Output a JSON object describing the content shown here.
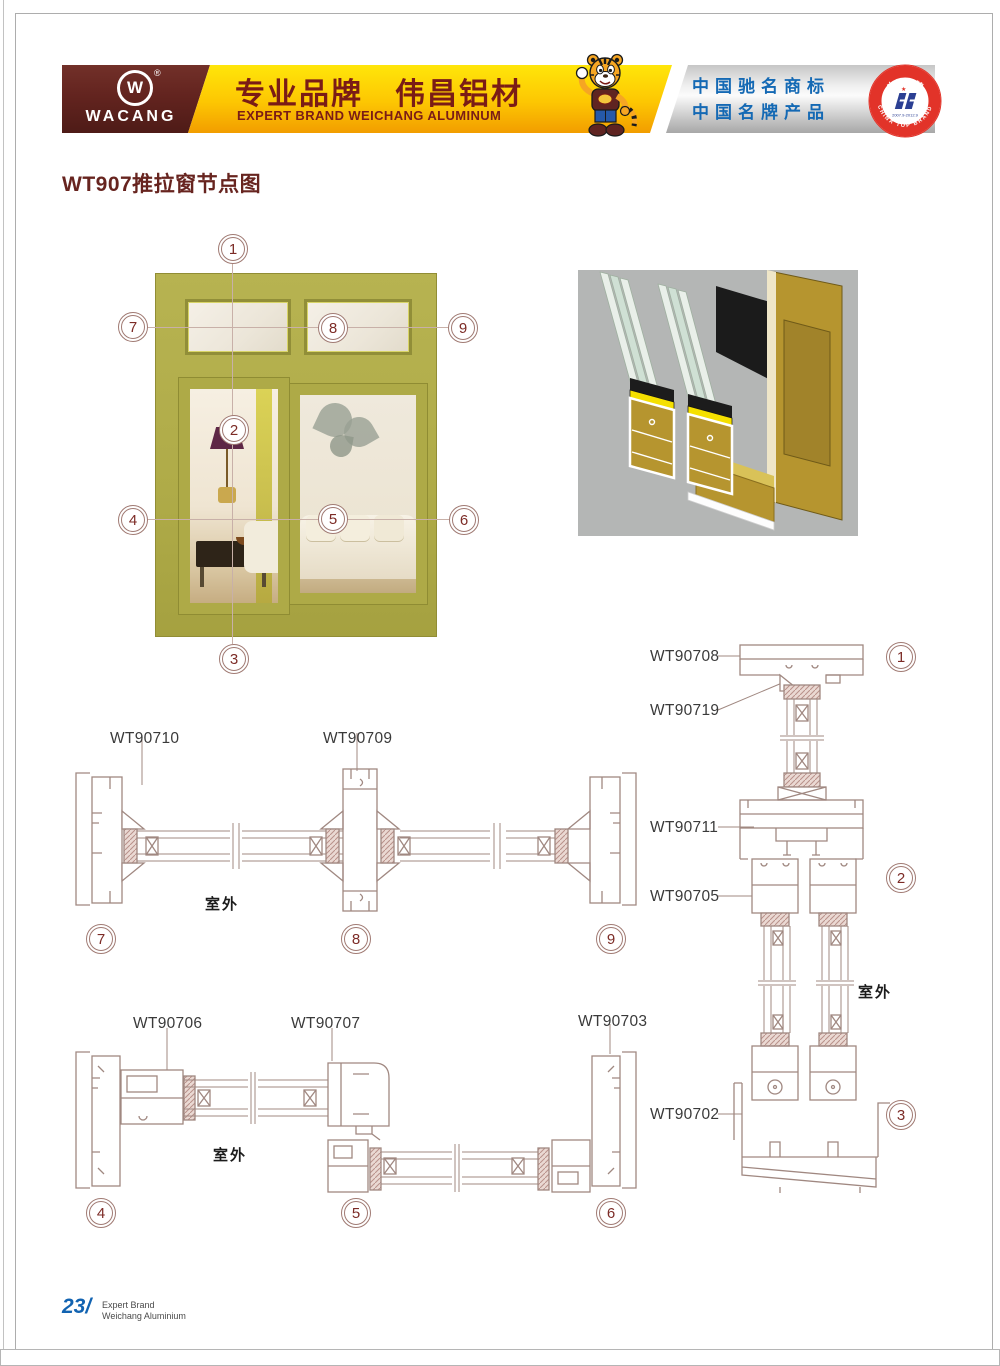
{
  "title": "WT907推拉窗节点图",
  "header": {
    "logo_monogram": "W",
    "logo_registered": "®",
    "logo_text": "WACANG",
    "brand_cn": "专业品牌　伟昌铝材",
    "brand_en": "EXPERT BRAND WEICHANG ALUMINUM",
    "honor_line1": "中国驰名商标",
    "honor_line2": "中国名牌产品",
    "badge_arc_top": "中国名牌",
    "badge_arc_bottom": "CHINA TOP BRAND",
    "badge_dates": "2007.9-2012.9"
  },
  "window_diagram": {
    "callouts": [
      "1",
      "2",
      "3",
      "4",
      "5",
      "6",
      "7",
      "8",
      "9"
    ]
  },
  "sections": {
    "mid": {
      "label_left": "WT90710",
      "label_center": "WT90709",
      "outdoor": "室外",
      "circle_left": "7",
      "circle_center": "8",
      "circle_right": "9"
    },
    "bottom": {
      "label_left": "WT90706",
      "label_center": "WT90707",
      "label_right": "WT90703",
      "outdoor": "室外",
      "circle_left": "4",
      "circle_center": "5",
      "circle_right": "6"
    },
    "right": {
      "label_1": "WT90708",
      "label_2": "WT90719",
      "label_3": "WT90711",
      "label_4": "WT90705",
      "label_5": "WT90702",
      "outdoor": "室外",
      "circle_1": "1",
      "circle_2": "2",
      "circle_3": "3"
    }
  },
  "footer": {
    "page_number": "23/",
    "brand_line1": "Expert Brand",
    "brand_line2": "Weichang Aluminium"
  },
  "colors": {
    "maroon": "#5f2421",
    "gold": "#fdc602",
    "orange": "#f29d00",
    "silver_band": "#c9c9c9",
    "honor_blue": "#1469b4",
    "badge_red": "#e23329",
    "badge_navy": "#2b3f93",
    "callout_red": "#7c2b26",
    "drawing_line": "#a08881",
    "window_olive": "#b2ae4b",
    "render_bg": "#b4b6b5",
    "render_gold": "#b6952f",
    "footer_blue": "#1263b1",
    "title_maroon": "#67241f"
  }
}
